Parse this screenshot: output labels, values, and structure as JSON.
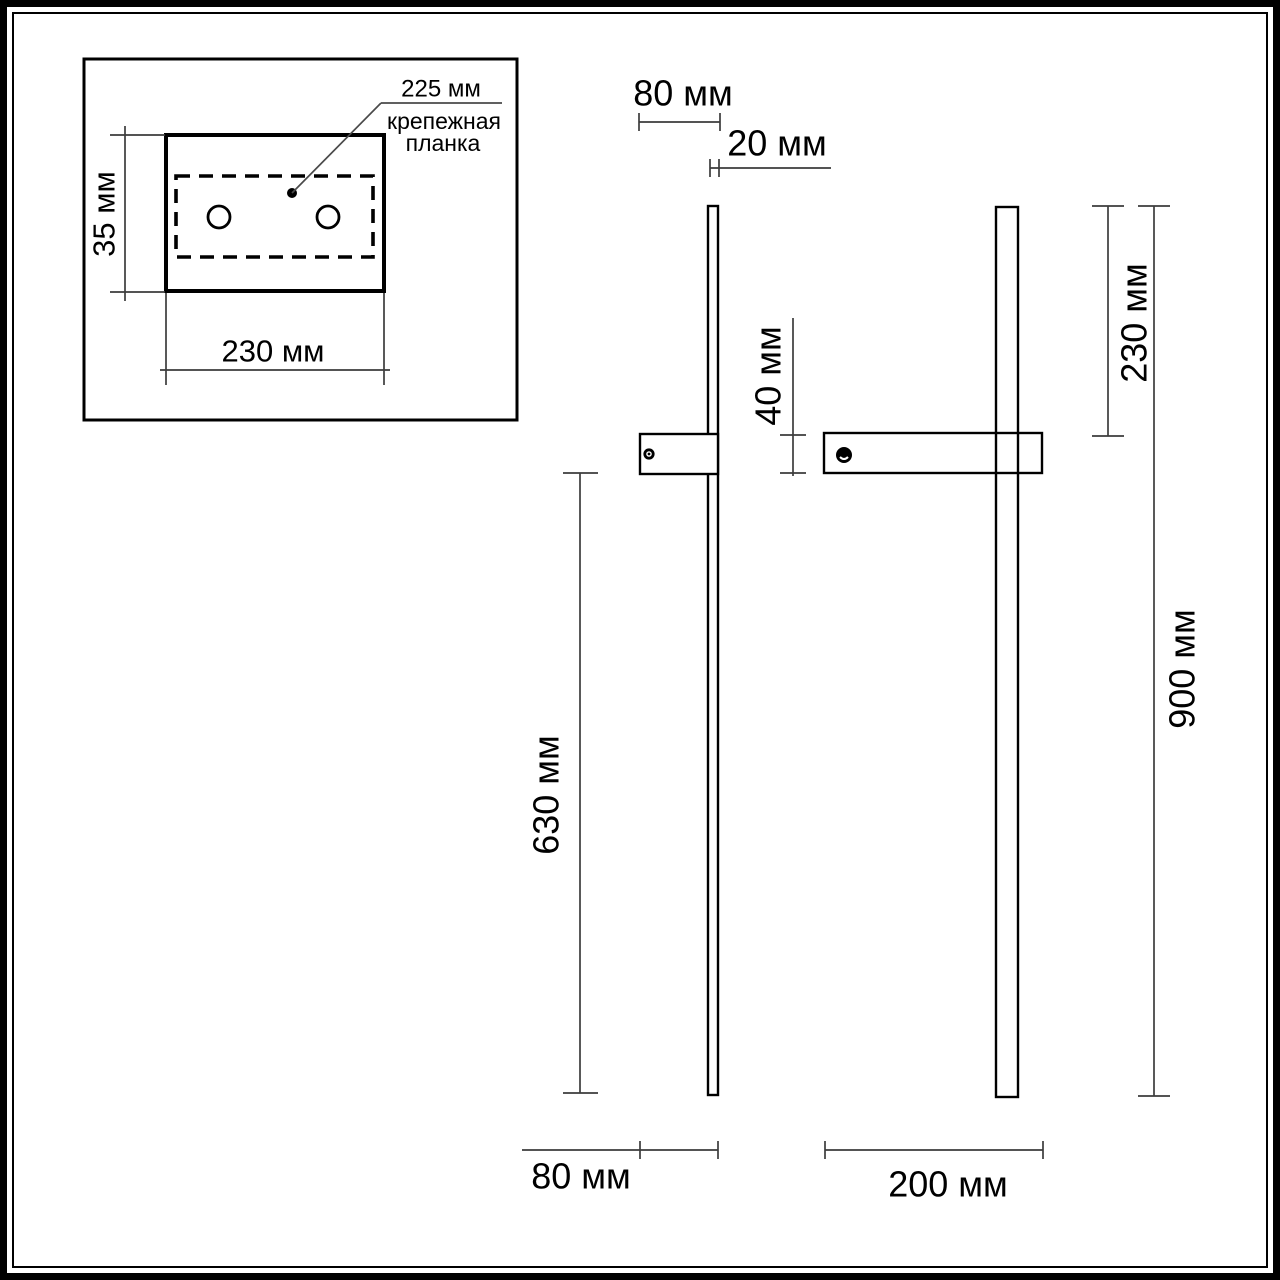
{
  "title": "wall-lamp dimensional drawing",
  "units": "мм",
  "colors": {
    "background": "#ffffff",
    "object_line": "#000000",
    "dimension_line": "#3c3c3c"
  },
  "inset": {
    "hole_spacing_label": "225 мм",
    "caption_line1": "крепежная",
    "caption_line2": "планка",
    "plate_height_label": "35 мм",
    "plate_width_label": "230 мм"
  },
  "side_view": {
    "top_depth_label": "80 мм",
    "bar_thickness_label": "20 мм",
    "plate_height_label": "40 мм",
    "length_below_plate_label": "630 мм",
    "bottom_depth_label": "80 мм"
  },
  "front_view": {
    "top_to_plate_label": "230 мм",
    "total_height_label": "900 мм",
    "plate_width_label": "200 мм"
  }
}
